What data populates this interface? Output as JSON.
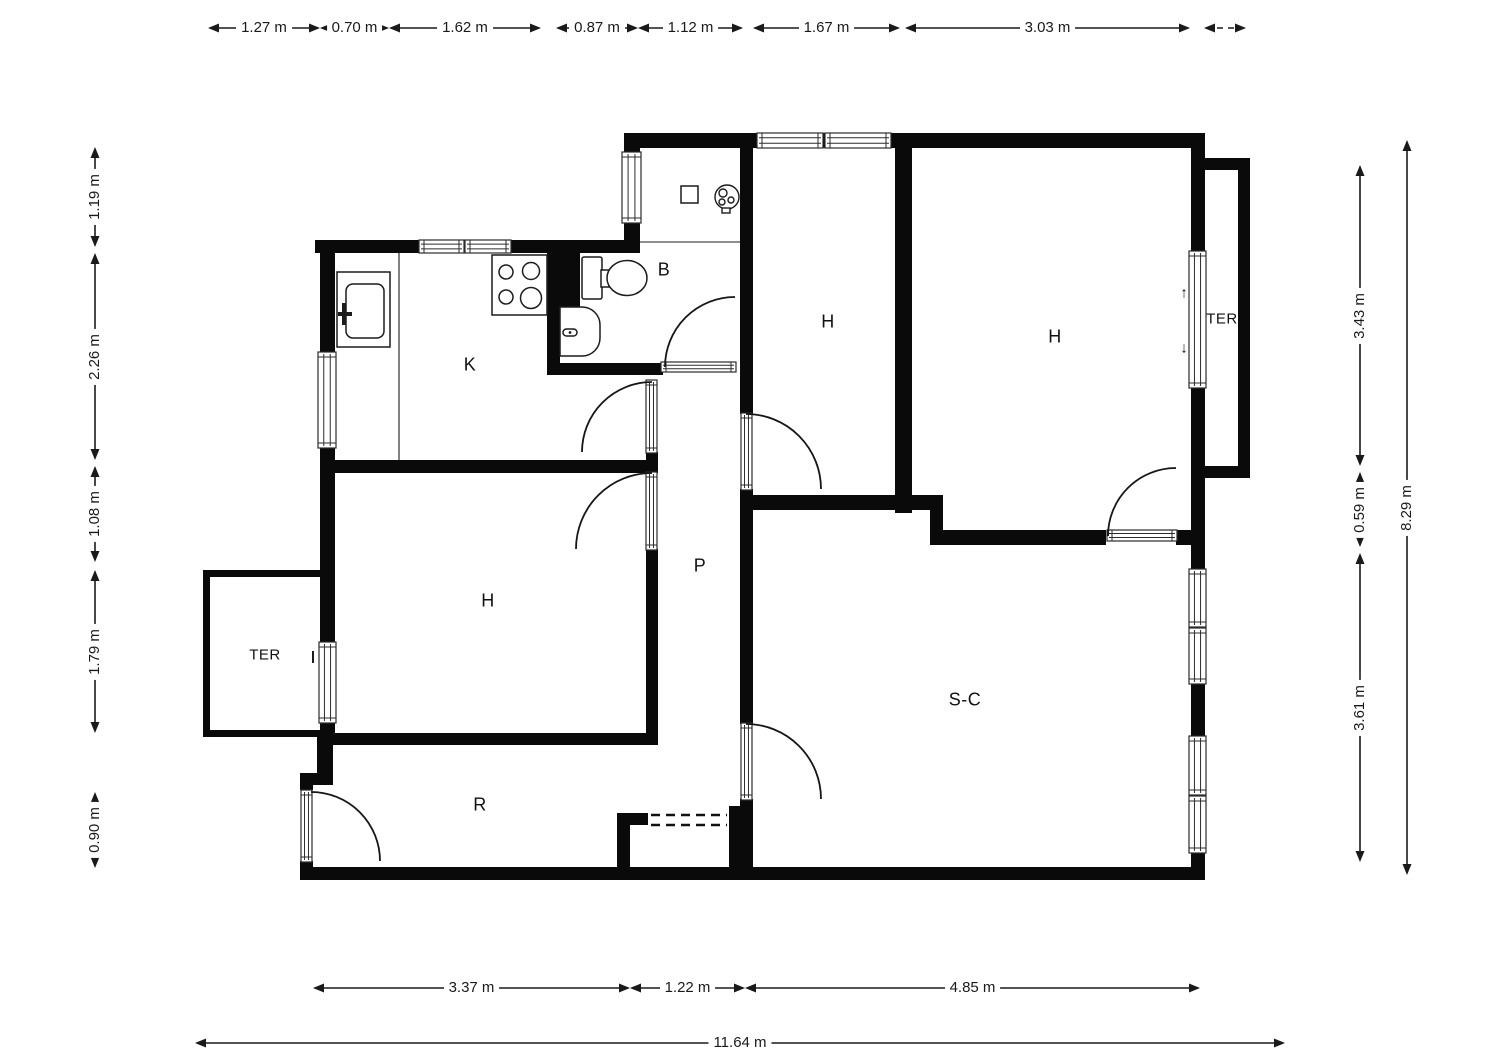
{
  "rooms": {
    "kitchen": "K",
    "bathroom": "B",
    "bedroom_left": "H",
    "bedroom_middle": "H",
    "bedroom_right": "H",
    "terrace_left": "TER",
    "terrace_right": "TER",
    "hallway": "P",
    "living_dining": "S-C",
    "reception": "R"
  },
  "dims": {
    "t1": "1.27 m",
    "t2": "0.70 m",
    "t3": "1.62 m",
    "t4": "0.87 m",
    "t5": "1.12 m",
    "t6": "1.67 m",
    "t7": "3.03 m",
    "l1": "1.19 m",
    "l2": "2.26 m",
    "l3": "1.08 m",
    "l4": "1.79 m",
    "l5": "0.90 m",
    "r1": "3.43 m",
    "r2": "0.59 m",
    "r3": "3.61 m",
    "r4": "8.29 m",
    "b1": "3.37 m",
    "b2": "1.22 m",
    "b3": "4.85 m",
    "b4": "11.64 m"
  },
  "glyphs": {
    "up_arrow": "↑",
    "down_arrow": "↓"
  },
  "colors": {
    "wall": "#0a0a0a",
    "line": "#2b2b2b",
    "background": "#ffffff"
  }
}
